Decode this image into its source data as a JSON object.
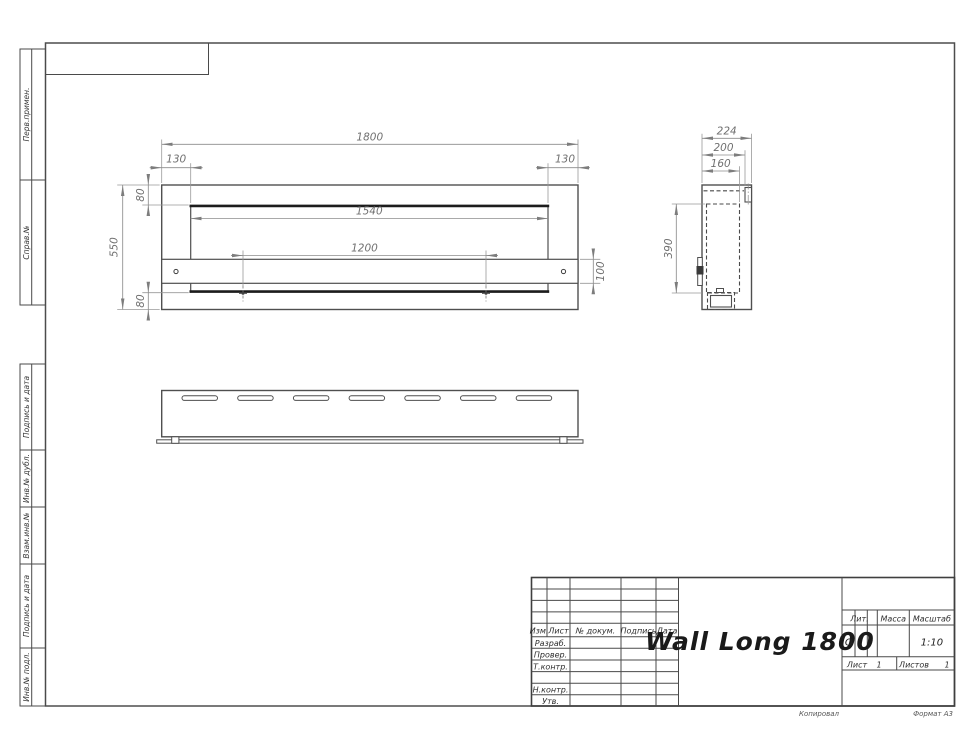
{
  "sheet": {
    "copied": "Копировал",
    "format": "Формат А3"
  },
  "sidebar": {
    "items": [
      {
        "label": "Перв.примен."
      },
      {
        "label": "Справ.№"
      },
      {
        "label": "Подпись и дата"
      },
      {
        "label": "Инв.№ дубл."
      },
      {
        "label": "Взам.инв.№"
      },
      {
        "label": "Подпись и дата"
      },
      {
        "label": "Инв.№ подл."
      }
    ]
  },
  "title_block": {
    "title": "Wall Long 1800",
    "columns": {
      "izm": "Изм.",
      "list": "Лист",
      "doc": "№ докум.",
      "sign": "Подпись",
      "date": "Дата"
    },
    "roles": [
      {
        "label": "Разраб."
      },
      {
        "label": "Провер."
      },
      {
        "label": "Т.контр."
      },
      {
        "label": "Н.контр."
      },
      {
        "label": "Утв."
      }
    ],
    "lit": {
      "label": "Лит.",
      "value": "О"
    },
    "mass": {
      "label": "Масса",
      "value": ""
    },
    "scale": {
      "label": "Масштаб",
      "value": "1:10"
    },
    "sheet": {
      "label": "Лист",
      "value": "1"
    },
    "sheets": {
      "label": "Листов",
      "value": "1"
    }
  },
  "dimensions": {
    "front": {
      "overall_width": "1800",
      "offset_left": "130",
      "offset_right": "130",
      "opening_width": "1540",
      "mount_spacing": "1200",
      "overall_height": "550",
      "top_margin": "80",
      "bottom_margin": "80",
      "bracket_height": "100"
    },
    "side": {
      "depth": "224",
      "mid_depth": "200",
      "inner_depth": "160",
      "inner_height": "390"
    }
  }
}
